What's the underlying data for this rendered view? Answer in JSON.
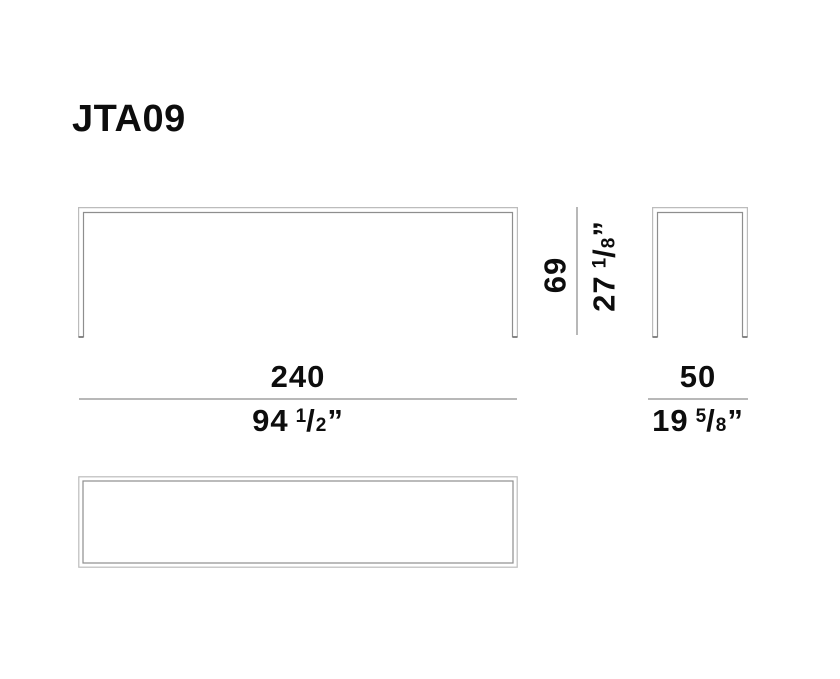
{
  "page": {
    "product_code": "JTA09"
  },
  "symbols": {
    "fraction_slash": "/",
    "inch_mark": "”"
  },
  "dimensions": {
    "width": {
      "cm": "240",
      "inch_whole": "94",
      "inch_num": "1",
      "inch_den": "2"
    },
    "depth": {
      "cm": "50",
      "inch_whole": "19",
      "inch_num": "5",
      "inch_den": "8"
    },
    "height": {
      "cm": "69",
      "inch_whole": "27",
      "inch_num": "1",
      "inch_den": "8"
    }
  },
  "colors": {
    "drawing_line_outer": "#bcbcbc",
    "drawing_line_inner": "#8e8e8e",
    "dimension_line": "#b8b8b8",
    "text": "#0d0d0d"
  }
}
